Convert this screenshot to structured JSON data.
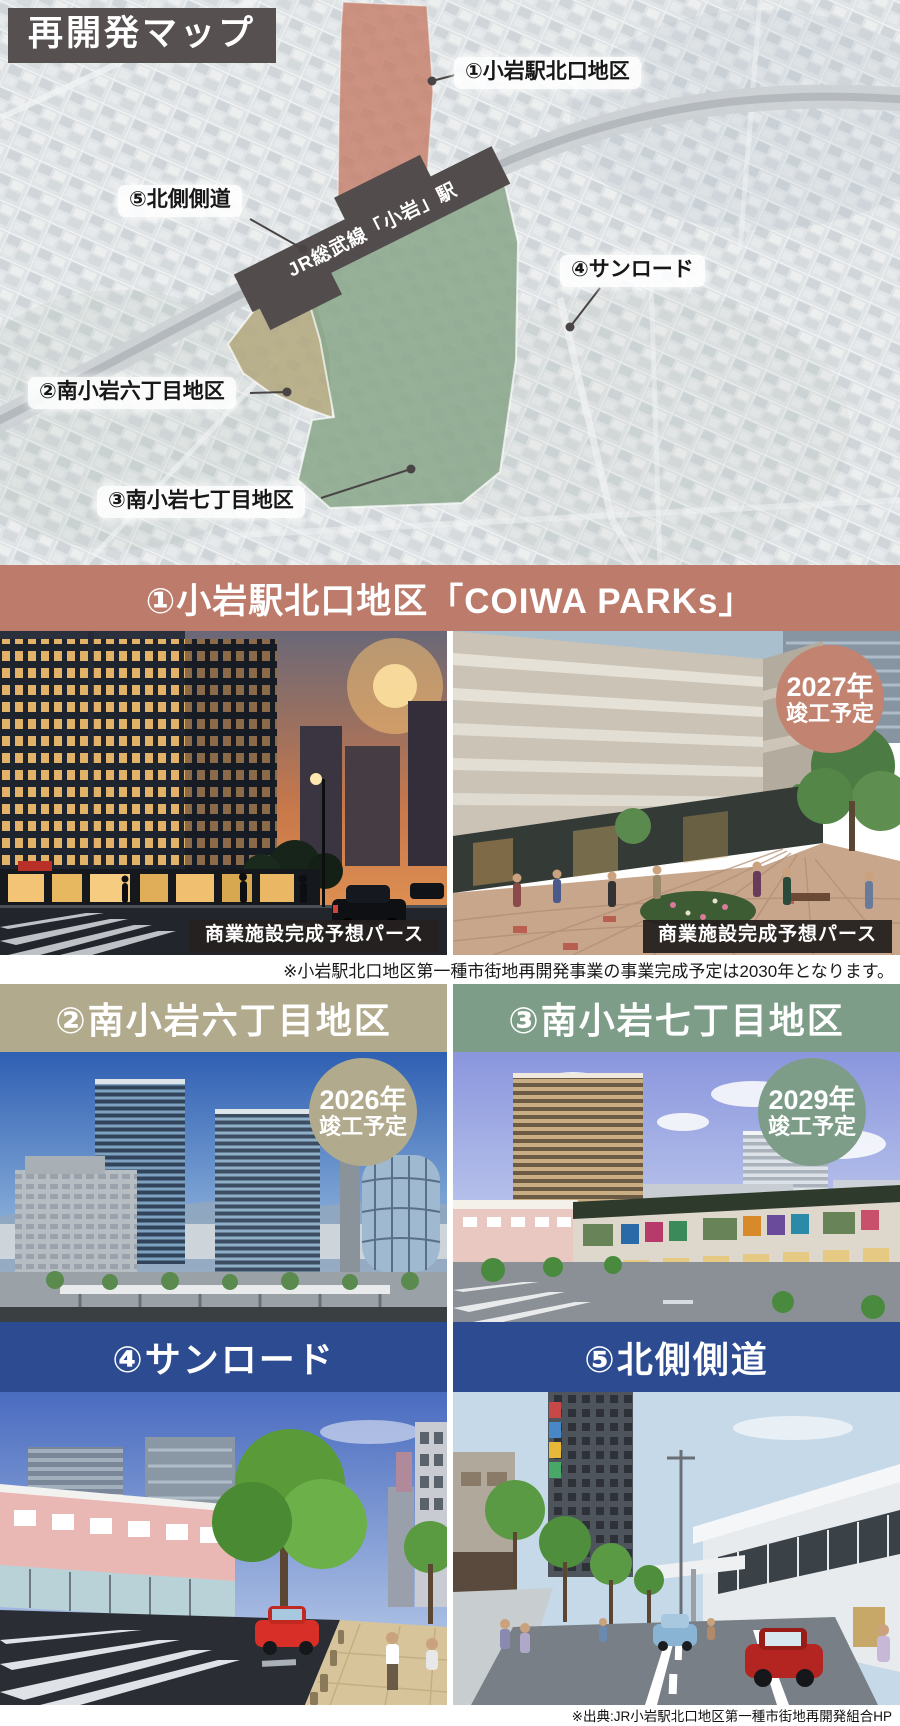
{
  "map": {
    "title": "再開発マップ",
    "station_label": "JR総武線「小岩」駅",
    "labels": {
      "area1": "①小岩駅北口地区",
      "area2": "②南小岩六丁目地区",
      "area3": "③南小岩七丁目地区",
      "area4": "④サンロード",
      "area5": "⑤北側側道"
    },
    "colors": {
      "title_bg": "#575051",
      "area1_fill": "#c47a66",
      "area2_fill": "#b3a87f",
      "area3_fill": "#8ba78c",
      "station_fill": "#524d4c",
      "pointer": "#4a4545"
    }
  },
  "section1": {
    "title": "①小岩駅北口地区「COIWA PARKs」",
    "color": "#bd7b6b",
    "left_caption": "商業施設完成予想パース",
    "right_caption": "商業施設完成予想パース",
    "caption_bg": "rgba(38,33,32,0.95)",
    "badge": {
      "line1": "2027年",
      "line2": "竣工予定",
      "color": "#c28370"
    },
    "note": "※小岩駅北口地区第一種市街地再開発事業の事業完成予定は2030年となります。"
  },
  "section2": {
    "title": "②南小岩六丁目地区",
    "color": "#b2aa8d",
    "badge": {
      "line1": "2026年",
      "line2": "竣工予定",
      "color": "#b2aa8d"
    }
  },
  "section3": {
    "title": "③南小岩七丁目地区",
    "color": "#7e9d88",
    "badge": {
      "line1": "2029年",
      "line2": "竣工予定",
      "color": "#7e9d88"
    }
  },
  "section4": {
    "title": "④サンロード",
    "color": "#2c4b90"
  },
  "section5": {
    "title": "⑤北側側道",
    "color": "#2c4b90"
  },
  "footer": {
    "source": "※出典:JR小岩駅北口地区第一種市街地再開発組合HP"
  }
}
